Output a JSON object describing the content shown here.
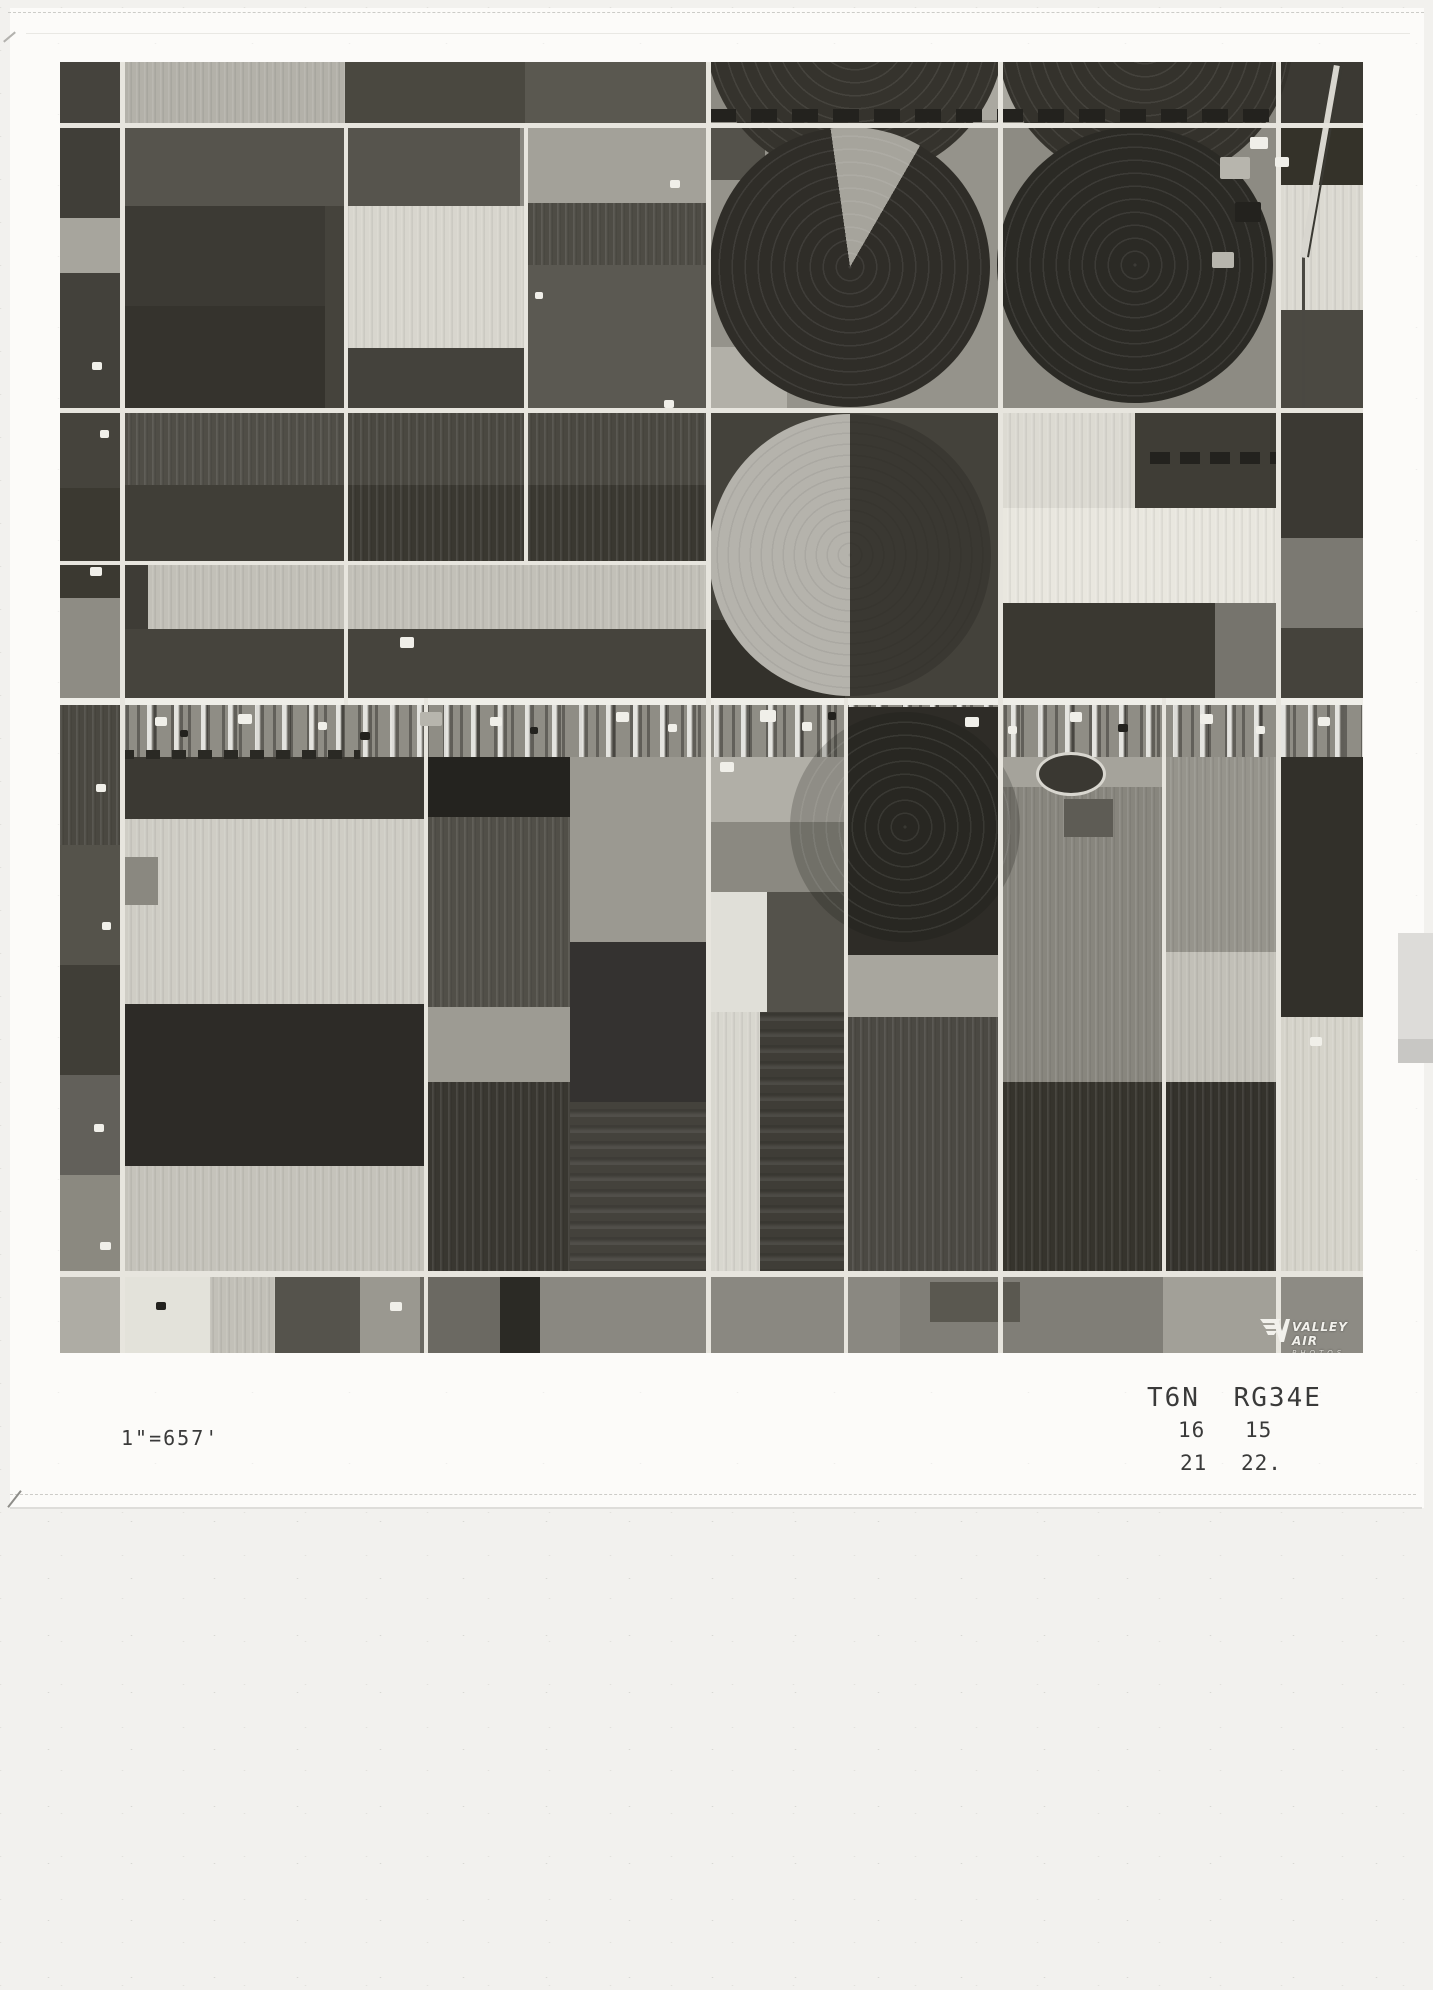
{
  "annotations": {
    "scale_label": "1\"=657'",
    "township_range": "T6N RG34E",
    "section_upper_left": "16",
    "section_upper_right": "15",
    "section_lower_left": "21",
    "section_lower_right": "22."
  },
  "logo": {
    "line1": "VALLEY AIR",
    "line2": "PHOTOS"
  },
  "photo": {
    "base_color": "#8b8982",
    "road_color": "#e7e5de",
    "speck_colors": [
      "#f0efe9",
      "#23221e",
      "#b7b5ad"
    ],
    "fields": [
      {
        "x": 0,
        "y": 0,
        "w": 60,
        "h": 61,
        "c": "#45433d"
      },
      {
        "x": 60,
        "y": 0,
        "w": 225,
        "h": 61,
        "c": "#b3b1a9",
        "t": "v"
      },
      {
        "x": 285,
        "y": 0,
        "w": 180,
        "h": 61,
        "c": "#4a4840"
      },
      {
        "x": 465,
        "y": 0,
        "w": 182,
        "h": 61,
        "c": "#5a5850"
      },
      {
        "x": 647,
        "y": 0,
        "w": 292,
        "h": 61,
        "c": "#8d8b83"
      },
      {
        "x": 939,
        "y": 0,
        "w": 277,
        "h": 61,
        "c": "#8a8880"
      },
      {
        "x": 910,
        "y": 0,
        "w": 58,
        "h": 58,
        "c": "#aaa8a0"
      },
      {
        "x": 1216,
        "y": 0,
        "w": 87,
        "h": 61,
        "c": "#3b3933"
      },
      {
        "x": 1100,
        "y": 4,
        "w": 100,
        "h": 52,
        "c": "#c3c1b9"
      },
      {
        "x": 0,
        "y": 61,
        "w": 60,
        "h": 95,
        "c": "#403e38"
      },
      {
        "x": 0,
        "y": 156,
        "w": 60,
        "h": 55,
        "c": "#a7a59d"
      },
      {
        "x": 0,
        "y": 211,
        "w": 60,
        "h": 135,
        "c": "#43413b"
      },
      {
        "x": 60,
        "y": 66,
        "w": 400,
        "h": 78,
        "c": "#56544d"
      },
      {
        "x": 60,
        "y": 144,
        "w": 205,
        "h": 100,
        "c": "#3c3a34"
      },
      {
        "x": 60,
        "y": 244,
        "w": 205,
        "h": 102,
        "c": "#35332d"
      },
      {
        "x": 265,
        "y": 144,
        "w": 20,
        "h": 202,
        "c": "#45433c"
      },
      {
        "x": 285,
        "y": 144,
        "w": 180,
        "h": 142,
        "c": "#d8d6ce",
        "t": "v"
      },
      {
        "x": 285,
        "y": 286,
        "w": 180,
        "h": 60,
        "c": "#44423c"
      },
      {
        "x": 465,
        "y": 66,
        "w": 182,
        "h": 75,
        "c": "#a3a199"
      },
      {
        "x": 465,
        "y": 141,
        "w": 182,
        "h": 62,
        "c": "#4e4c45",
        "t": "v"
      },
      {
        "x": 465,
        "y": 203,
        "w": 182,
        "h": 143,
        "c": "#5b5952"
      },
      {
        "x": 647,
        "y": 61,
        "w": 292,
        "h": 285,
        "c": "#95938b"
      },
      {
        "x": 939,
        "y": 61,
        "w": 277,
        "h": 285,
        "c": "#8d8b83"
      },
      {
        "x": 647,
        "y": 66,
        "w": 58,
        "h": 52,
        "c": "#54524b"
      },
      {
        "x": 647,
        "y": 285,
        "w": 80,
        "h": 61,
        "c": "#b2b0a8"
      },
      {
        "x": 1216,
        "y": 61,
        "w": 87,
        "h": 62,
        "c": "#343229"
      },
      {
        "x": 1216,
        "y": 123,
        "w": 87,
        "h": 125,
        "c": "#dcdad2",
        "t": "v"
      },
      {
        "x": 1216,
        "y": 248,
        "w": 87,
        "h": 98,
        "c": "#4b4942"
      },
      {
        "x": 1242,
        "y": 190,
        "w": 3,
        "h": 158,
        "c": "#4a4842"
      },
      {
        "x": 0,
        "y": 346,
        "w": 60,
        "h": 80,
        "c": "#45433c"
      },
      {
        "x": 0,
        "y": 426,
        "w": 60,
        "h": 110,
        "c": "#3b3931"
      },
      {
        "x": 0,
        "y": 536,
        "w": 60,
        "h": 107,
        "c": "#8e8c84"
      },
      {
        "x": 60,
        "y": 351,
        "w": 224,
        "h": 72,
        "c": "#504e47",
        "t": "v"
      },
      {
        "x": 284,
        "y": 351,
        "w": 363,
        "h": 72,
        "c": "#4a4841",
        "t": "v"
      },
      {
        "x": 60,
        "y": 423,
        "w": 224,
        "h": 78,
        "c": "#403e37"
      },
      {
        "x": 284,
        "y": 423,
        "w": 363,
        "h": 78,
        "c": "#3a3831",
        "t": "v"
      },
      {
        "x": 60,
        "y": 503,
        "w": 587,
        "h": 64,
        "c": "#c2c0b8",
        "t": "v"
      },
      {
        "x": 60,
        "y": 503,
        "w": 28,
        "h": 64,
        "c": "#3e3c36"
      },
      {
        "x": 60,
        "y": 567,
        "w": 587,
        "h": 69,
        "c": "#46443d"
      },
      {
        "x": 647,
        "y": 346,
        "w": 292,
        "h": 290,
        "c": "#44423b"
      },
      {
        "x": 647,
        "y": 558,
        "w": 138,
        "h": 78,
        "c": "#33312b"
      },
      {
        "x": 939,
        "y": 346,
        "w": 136,
        "h": 100,
        "c": "#dcdad2",
        "t": "v"
      },
      {
        "x": 1075,
        "y": 346,
        "w": 141,
        "h": 100,
        "c": "#3f3d36"
      },
      {
        "x": 939,
        "y": 446,
        "w": 277,
        "h": 95,
        "c": "#e9e7df",
        "t": "v"
      },
      {
        "x": 939,
        "y": 541,
        "w": 216,
        "h": 95,
        "c": "#3a3831"
      },
      {
        "x": 1155,
        "y": 541,
        "w": 61,
        "h": 95,
        "c": "#76746d"
      },
      {
        "x": 1216,
        "y": 346,
        "w": 87,
        "h": 130,
        "c": "#3b3933"
      },
      {
        "x": 1216,
        "y": 476,
        "w": 87,
        "h": 90,
        "c": "#7b7972"
      },
      {
        "x": 1216,
        "y": 566,
        "w": 87,
        "h": 70,
        "c": "#45433c"
      },
      {
        "x": 60,
        "y": 643,
        "w": 1243,
        "h": 52,
        "c": "#8f8d85",
        "t": "sp"
      },
      {
        "x": 0,
        "y": 643,
        "w": 60,
        "h": 140,
        "c": "#4a4841",
        "t": "v"
      },
      {
        "x": 0,
        "y": 783,
        "w": 60,
        "h": 120,
        "c": "#55534b"
      },
      {
        "x": 0,
        "y": 903,
        "w": 60,
        "h": 110,
        "c": "#403e37"
      },
      {
        "x": 0,
        "y": 1013,
        "w": 60,
        "h": 100,
        "c": "#62605a"
      },
      {
        "x": 0,
        "y": 1113,
        "w": 60,
        "h": 102,
        "c": "#8b8980"
      },
      {
        "x": 60,
        "y": 695,
        "w": 304,
        "h": 62,
        "c": "#3b3933"
      },
      {
        "x": 60,
        "y": 757,
        "w": 304,
        "h": 185,
        "c": "#cfcdc5",
        "t": "v"
      },
      {
        "x": 60,
        "y": 942,
        "w": 304,
        "h": 162,
        "c": "#2d2b27"
      },
      {
        "x": 60,
        "y": 1104,
        "w": 304,
        "h": 111,
        "c": "#c5c3bb",
        "t": "v"
      },
      {
        "x": 60,
        "y": 795,
        "w": 38,
        "h": 48,
        "c": "#8a8880"
      },
      {
        "x": 364,
        "y": 695,
        "w": 146,
        "h": 60,
        "c": "#24231f"
      },
      {
        "x": 364,
        "y": 755,
        "w": 146,
        "h": 190,
        "c": "#514f48",
        "t": "v"
      },
      {
        "x": 364,
        "y": 945,
        "w": 146,
        "h": 75,
        "c": "#9d9b93"
      },
      {
        "x": 364,
        "y": 1020,
        "w": 146,
        "h": 195,
        "c": "#393731",
        "t": "v"
      },
      {
        "x": 510,
        "y": 695,
        "w": 137,
        "h": 185,
        "c": "#9b9991"
      },
      {
        "x": 510,
        "y": 880,
        "w": 137,
        "h": 160,
        "c": "#343230"
      },
      {
        "x": 510,
        "y": 1040,
        "w": 137,
        "h": 175,
        "c": "#44423c",
        "t": "h"
      },
      {
        "x": 647,
        "y": 695,
        "w": 137,
        "h": 65,
        "c": "#b1afa7"
      },
      {
        "x": 647,
        "y": 760,
        "w": 137,
        "h": 70,
        "c": "#8b8981"
      },
      {
        "x": 647,
        "y": 830,
        "w": 60,
        "h": 120,
        "c": "#e0dfd8"
      },
      {
        "x": 707,
        "y": 830,
        "w": 77,
        "h": 120,
        "c": "#54524b"
      },
      {
        "x": 647,
        "y": 950,
        "w": 53,
        "h": 265,
        "c": "#d8d7cf",
        "t": "v"
      },
      {
        "x": 700,
        "y": 950,
        "w": 84,
        "h": 265,
        "c": "#3f3d37",
        "t": "h"
      },
      {
        "x": 784,
        "y": 645,
        "w": 155,
        "h": 248,
        "c": "#2e2c27"
      },
      {
        "x": 784,
        "y": 893,
        "w": 155,
        "h": 62,
        "c": "#a8a69e"
      },
      {
        "x": 784,
        "y": 955,
        "w": 155,
        "h": 260,
        "c": "#4b4943",
        "t": "v"
      },
      {
        "x": 939,
        "y": 695,
        "w": 163,
        "h": 30,
        "c": "#a5a39b"
      },
      {
        "x": 939,
        "y": 725,
        "w": 163,
        "h": 295,
        "c": "#88867e",
        "t": "v"
      },
      {
        "x": 1004,
        "y": 737,
        "w": 49,
        "h": 38,
        "c": "#5e5c55"
      },
      {
        "x": 939,
        "y": 1020,
        "w": 163,
        "h": 195,
        "c": "#36342d",
        "t": "v"
      },
      {
        "x": 1102,
        "y": 695,
        "w": 114,
        "h": 195,
        "c": "#96948c",
        "t": "v"
      },
      {
        "x": 1102,
        "y": 890,
        "w": 114,
        "h": 130,
        "c": "#c2c0b8",
        "t": "v"
      },
      {
        "x": 1102,
        "y": 1020,
        "w": 114,
        "h": 195,
        "c": "#34322c",
        "t": "v"
      },
      {
        "x": 1216,
        "y": 695,
        "w": 87,
        "h": 260,
        "c": "#32302a"
      },
      {
        "x": 1216,
        "y": 955,
        "w": 87,
        "h": 260,
        "c": "#d6d4cb",
        "t": "v"
      },
      {
        "x": 0,
        "y": 1215,
        "w": 60,
        "h": 76,
        "c": "#aeaca4"
      },
      {
        "x": 60,
        "y": 1215,
        "w": 90,
        "h": 76,
        "c": "#e3e2da"
      },
      {
        "x": 150,
        "y": 1215,
        "w": 65,
        "h": 76,
        "c": "#c2c0b8",
        "t": "v"
      },
      {
        "x": 215,
        "y": 1215,
        "w": 85,
        "h": 76,
        "c": "#55534c"
      },
      {
        "x": 300,
        "y": 1215,
        "w": 60,
        "h": 76,
        "c": "#9a9890"
      },
      {
        "x": 360,
        "y": 1215,
        "w": 80,
        "h": 76,
        "c": "#6b6962"
      },
      {
        "x": 440,
        "y": 1215,
        "w": 40,
        "h": 76,
        "c": "#2b2a25"
      },
      {
        "x": 480,
        "y": 1215,
        "w": 360,
        "h": 76,
        "c": "#8a8881"
      },
      {
        "x": 840,
        "y": 1215,
        "w": 263,
        "h": 76,
        "c": "#807e77"
      },
      {
        "x": 870,
        "y": 1220,
        "w": 90,
        "h": 40,
        "c": "#5a5850"
      },
      {
        "x": 1103,
        "y": 1215,
        "w": 113,
        "h": 76,
        "c": "#a2a098"
      },
      {
        "x": 1216,
        "y": 1215,
        "w": 87,
        "h": 76,
        "c": "#8d8b84"
      }
    ],
    "circles": [
      {
        "cx": 795,
        "cy": -32,
        "r": 150,
        "c": "#35332d",
        "rings": "light"
      },
      {
        "cx": 1085,
        "cy": -25,
        "r": 148,
        "c": "#34322c",
        "rings": "light"
      },
      {
        "cx": 790,
        "cy": 205,
        "r": 140,
        "c": "#2f2d28",
        "rings": "light",
        "wedge": {
          "from": -8,
          "to": 30,
          "c": "#a6a49c"
        }
      },
      {
        "cx": 1075,
        "cy": 203,
        "r": 138,
        "c": "#2b2a25",
        "rings": "light"
      },
      {
        "cx": 790,
        "cy": 493,
        "r": 141,
        "half": [
          "#b5b3ac",
          "#3a3832"
        ],
        "rings": "dark"
      },
      {
        "cx": 845,
        "cy": 765,
        "r": 115,
        "c": "rgba(22,21,17,0.22)",
        "rings": "light"
      }
    ],
    "tree_rows": [
      {
        "x": 650,
        "y": 47,
        "w": 566,
        "h": 13,
        "c": "#23221e",
        "seg": 26,
        "gap": 15
      },
      {
        "x": 1090,
        "y": 390,
        "w": 126,
        "h": 12,
        "c": "#23221e",
        "seg": 20,
        "gap": 10
      },
      {
        "x": 60,
        "y": 688,
        "w": 240,
        "h": 9,
        "c": "#2a2924",
        "seg": 14,
        "gap": 12
      }
    ],
    "oval": {
      "x": 976,
      "y": 690,
      "w": 64,
      "h": 38,
      "ring": "#d8d6cf",
      "c": "#3a3832"
    },
    "diagonals": [
      {
        "x": 1240,
        "y": 0,
        "w": 6,
        "h": 195,
        "angle": 10,
        "c": "#d8d6cf"
      },
      {
        "x": 1247,
        "y": 0,
        "w": 2,
        "h": 195,
        "angle": 10,
        "c": "#3a3933"
      }
    ],
    "roads": [
      {
        "x": 0,
        "y": 61,
        "w": 1303,
        "h": 5
      },
      {
        "x": 0,
        "y": 346,
        "w": 1303,
        "h": 5
      },
      {
        "x": 0,
        "y": 499,
        "w": 650,
        "h": 4
      },
      {
        "x": 0,
        "y": 636,
        "w": 1303,
        "h": 7,
        "c": "#efeee8"
      },
      {
        "x": 0,
        "y": 1209,
        "w": 1303,
        "h": 6
      },
      {
        "x": 60,
        "y": 0,
        "w": 5,
        "h": 1291
      },
      {
        "x": 284,
        "y": 61,
        "w": 4,
        "h": 582
      },
      {
        "x": 464,
        "y": 61,
        "w": 4,
        "h": 440
      },
      {
        "x": 364,
        "y": 636,
        "w": 4,
        "h": 655
      },
      {
        "x": 646,
        "y": 0,
        "w": 5,
        "h": 1291
      },
      {
        "x": 784,
        "y": 636,
        "w": 4,
        "h": 655
      },
      {
        "x": 938,
        "y": 0,
        "w": 5,
        "h": 1291
      },
      {
        "x": 1102,
        "y": 636,
        "w": 4,
        "h": 579
      },
      {
        "x": 1216,
        "y": 0,
        "w": 5,
        "h": 1291
      }
    ],
    "specks": [
      [
        95,
        655,
        12,
        9,
        0
      ],
      [
        120,
        668,
        8,
        7,
        1
      ],
      [
        178,
        652,
        14,
        10,
        0
      ],
      [
        258,
        660,
        9,
        8,
        0
      ],
      [
        300,
        670,
        10,
        8,
        1
      ],
      [
        430,
        655,
        12,
        9,
        0
      ],
      [
        470,
        665,
        8,
        7,
        1
      ],
      [
        556,
        650,
        13,
        10,
        0
      ],
      [
        608,
        662,
        9,
        8,
        0
      ],
      [
        700,
        648,
        16,
        12,
        0
      ],
      [
        742,
        660,
        10,
        9,
        0
      ],
      [
        768,
        650,
        8,
        8,
        1
      ],
      [
        905,
        655,
        14,
        10,
        0
      ],
      [
        948,
        664,
        9,
        8,
        0
      ],
      [
        1010,
        650,
        12,
        10,
        0
      ],
      [
        1058,
        662,
        10,
        8,
        1
      ],
      [
        1140,
        652,
        13,
        10,
        0
      ],
      [
        1196,
        664,
        9,
        8,
        0
      ],
      [
        1258,
        655,
        12,
        9,
        0
      ],
      [
        32,
        300,
        10,
        8,
        0
      ],
      [
        40,
        368,
        9,
        8,
        0
      ],
      [
        30,
        505,
        12,
        9,
        0
      ],
      [
        36,
        722,
        10,
        8,
        0
      ],
      [
        42,
        860,
        9,
        8,
        0
      ],
      [
        34,
        1062,
        10,
        8,
        0
      ],
      [
        40,
        1180,
        11,
        8,
        0
      ],
      [
        340,
        575,
        14,
        11,
        0
      ],
      [
        604,
        338,
        10,
        8,
        0
      ],
      [
        1250,
        975,
        12,
        9,
        0
      ],
      [
        330,
        1240,
        12,
        9,
        0
      ],
      [
        96,
        1240,
        10,
        8,
        1
      ],
      [
        610,
        118,
        10,
        8,
        0
      ],
      [
        475,
        230,
        8,
        7,
        0
      ],
      [
        1160,
        95,
        30,
        22,
        2
      ],
      [
        1175,
        140,
        26,
        20,
        1
      ],
      [
        1152,
        190,
        22,
        16,
        2
      ],
      [
        1190,
        75,
        18,
        12,
        0
      ],
      [
        1215,
        95,
        14,
        10,
        0
      ],
      [
        360,
        650,
        22,
        14,
        2
      ],
      [
        660,
        700,
        14,
        10,
        0
      ]
    ]
  }
}
